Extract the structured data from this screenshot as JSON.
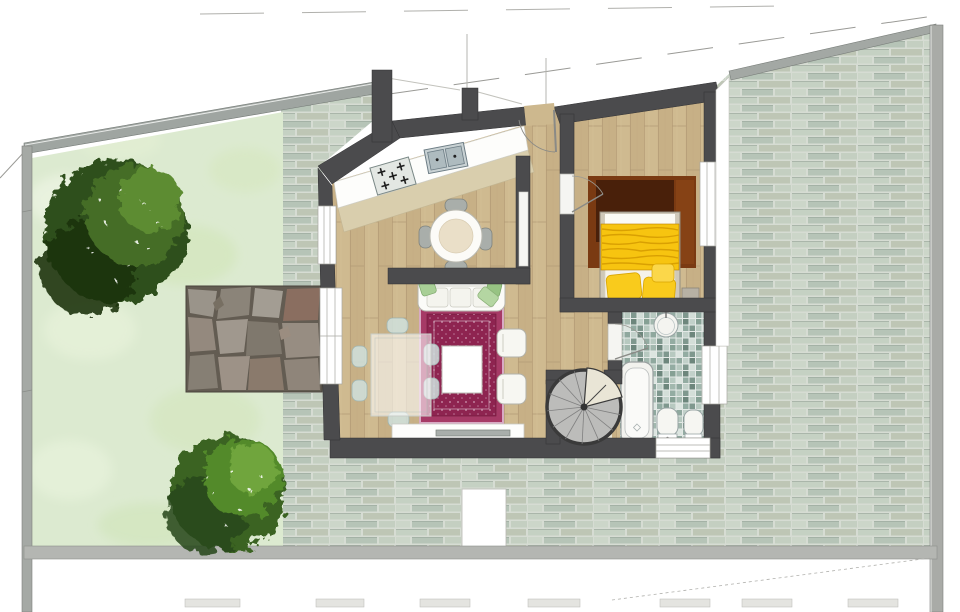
{
  "scene": {
    "type": "residential-floor-plan-render",
    "rooms": [
      "kitchen",
      "dining-nook",
      "living-room",
      "entrance-hall",
      "corridor",
      "bedroom",
      "bathroom",
      "stair-closet",
      "garden",
      "stone-patio",
      "paved-courtyard"
    ],
    "furniture": [
      "kitchen-counter",
      "gas-hob",
      "double-sink",
      "round-breakfast-table",
      "breakfast-chairs",
      "glass-dining-table",
      "dining-chairs",
      "sofa",
      "green-throw-pillows",
      "oriental-rug",
      "coffee-table",
      "armchairs",
      "tv-sideboard",
      "double-bed",
      "yellow-blanket",
      "yellow-pillows",
      "bedside-table",
      "bedroom-rug",
      "spiral-staircase",
      "bathtub",
      "round-basin",
      "toilet",
      "bidet",
      "garden-trees"
    ]
  },
  "colors": {
    "wall": "#4b4b4d",
    "boundary": "#a5a9a5",
    "boundary_dark": "#9fa5a1",
    "band": "#b4b6b2",
    "garden": "#dcead0",
    "wood": "#cdb88e",
    "counter": "#fdfdfb",
    "tile_band": "#d9cead",
    "rug_field": "#8e2450",
    "rug_border": "#a63a66",
    "rug_edge": "#d8aac4",
    "sofa": "#fbfbf8",
    "pillow_green": "#a8cf96",
    "blanket": "#f7c410",
    "bed_rug_dark": "#49200a",
    "bed_rug": "#7a3a12",
    "cream": "#e9e5d6",
    "stone_joint": "#635c52",
    "stair_tread": "#bcbcba",
    "tree1_dark": "#2f4f1c",
    "tree1_mid": "#446d26",
    "tree1_light": "#5d8c33",
    "tree2_base": "#3a6320",
    "tree2_mid": "#538a2b",
    "tree2_light": "#6fa53c",
    "fixture": "#f4f4f0",
    "glass": "#cfe0dd"
  }
}
